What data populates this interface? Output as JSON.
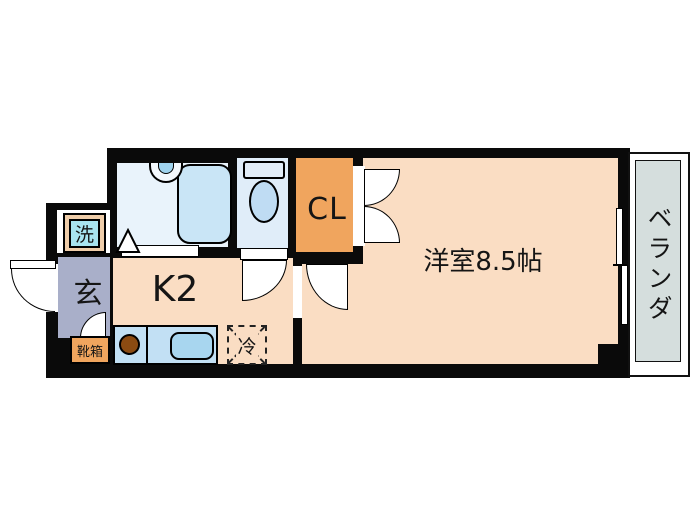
{
  "floorplan": {
    "labels": {
      "kitchen": "K2",
      "western_room": "洋室8.5帖",
      "closet": "CL",
      "entrance": "玄",
      "shoe_box": "靴箱",
      "laundry": "洗",
      "refrigerator": "冷",
      "balcony": "ベランダ"
    },
    "colors": {
      "wall": "#0a0a0a",
      "room_peach": "#faddc3",
      "closet_orange": "#f0a55e",
      "entrance_gray": "#a9afc9",
      "bathroom_blue": "#e9f3fb",
      "toilet_blue": "#e0edf9",
      "tub_blue": "#c9e5f6",
      "counter_blue": "#c2e0f4",
      "sink_blue": "#a8d6ef",
      "laundry_cyan": "#a8e4f0",
      "laundry_frame_tan": "#efcda9",
      "burner_brown": "#8b4b12",
      "balcony_gray": "#d5dedd"
    }
  }
}
